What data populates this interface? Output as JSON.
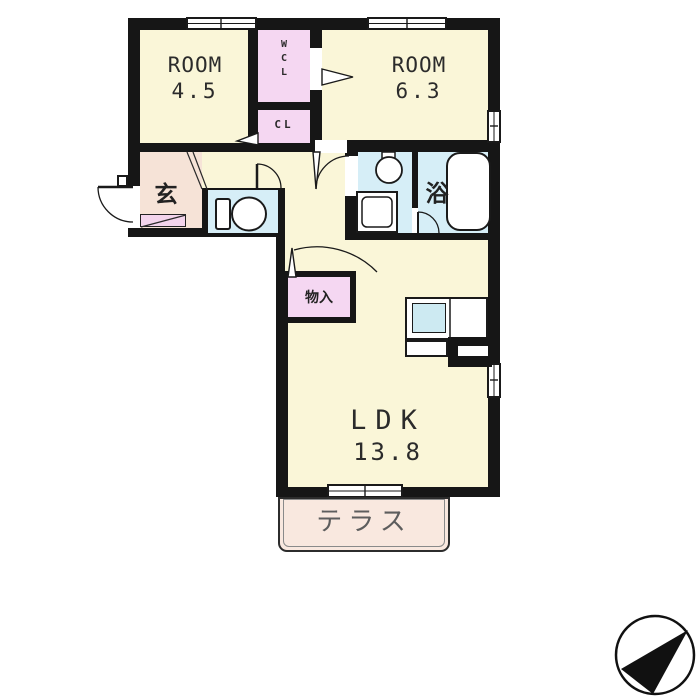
{
  "plan_title": "apartment-floor-plan",
  "rooms": {
    "room45": {
      "name": "ROOM",
      "area": "4.5"
    },
    "wcl": {
      "l1": "W",
      "l2": "C",
      "l3": "L"
    },
    "cl": {
      "name": "CL"
    },
    "room63": {
      "name": "ROOM",
      "area": "6.3"
    },
    "genkan": {
      "name": "玄"
    },
    "bath": {
      "name": "浴"
    },
    "storage": {
      "name": "物入"
    },
    "ldk": {
      "name": "LDK",
      "area": "13.8"
    },
    "terrace": {
      "name": "テラス"
    }
  },
  "colors": {
    "wall": "#161616",
    "room_yellow": "#faf6d8",
    "closet_pink": "#f5d7f2",
    "wet_area_blue": "#d6eef7",
    "genkan_beige": "#f6e3d7",
    "shoe_cabinet_pink": "#f3d4ec",
    "terrace_peach": "#f9e8df",
    "kitchen_sink_blue": "#cdeaf2"
  },
  "icons": {
    "compass": "northeast-arrow"
  }
}
